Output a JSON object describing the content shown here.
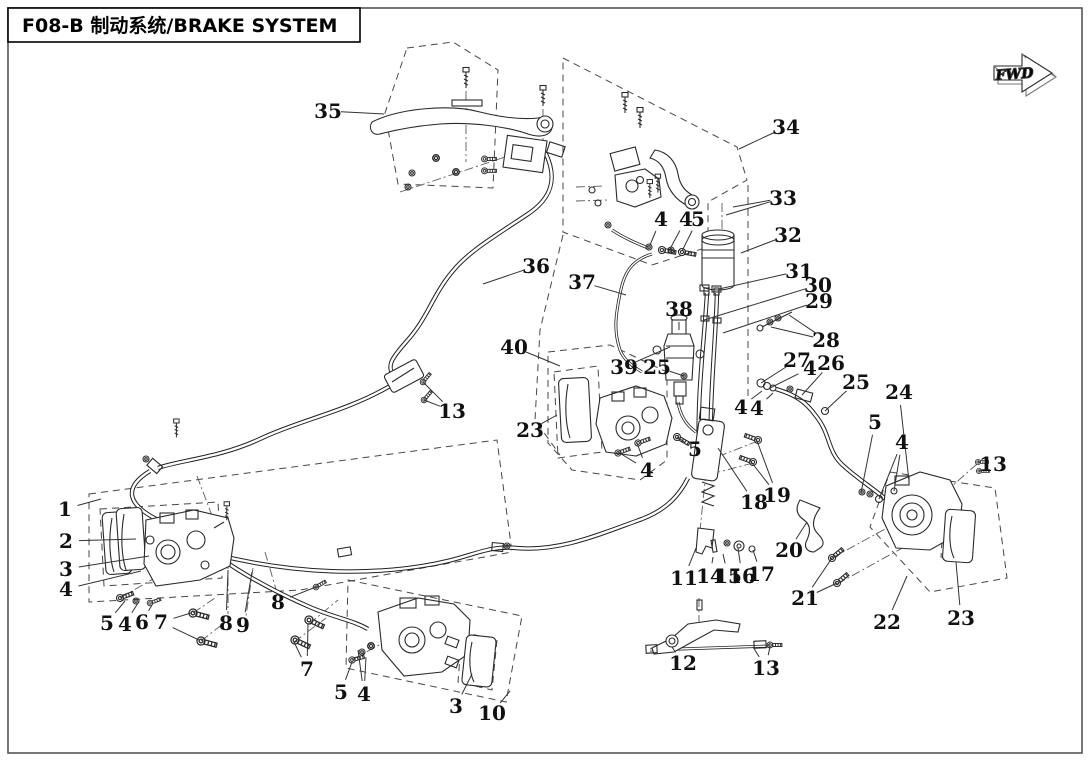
{
  "header": {
    "title": "F08-B 制动系统/BRAKE SYSTEM",
    "fwd": "FWD"
  },
  "parts": [
    {
      "label": "35",
      "x": 328,
      "y": 111,
      "leaders": [
        [
          384,
          114
        ]
      ]
    },
    {
      "label": "36",
      "x": 536,
      "y": 266,
      "leaders": [
        [
          483,
          284
        ]
      ]
    },
    {
      "label": "13",
      "x": 452,
      "y": 411,
      "leaders": [
        [
          423,
          382
        ],
        [
          424,
          400
        ]
      ]
    },
    {
      "label": "34",
      "x": 786,
      "y": 127,
      "leaders": [
        [
          739,
          149
        ]
      ]
    },
    {
      "label": "33",
      "x": 783,
      "y": 198,
      "leaders": [
        [
          726,
          215
        ],
        [
          733,
          207
        ]
      ]
    },
    {
      "label": "32",
      "x": 788,
      "y": 235,
      "leaders": [
        [
          741,
          253
        ]
      ]
    },
    {
      "label": "4",
      "x": 661,
      "y": 219,
      "leaders": [
        [
          650,
          245
        ]
      ]
    },
    {
      "label": "4",
      "x": 686,
      "y": 219,
      "leaders": [
        [
          670,
          249
        ]
      ]
    },
    {
      "label": "5",
      "x": 698,
      "y": 219,
      "leaders": [
        [
          682,
          251
        ]
      ]
    },
    {
      "label": "37",
      "x": 582,
      "y": 282,
      "leaders": [
        [
          626,
          295
        ]
      ]
    },
    {
      "label": "38",
      "x": 679,
      "y": 309,
      "leaders": [
        [
          679,
          330
        ]
      ]
    },
    {
      "label": "31",
      "x": 799,
      "y": 271,
      "leaders": [
        [
          719,
          289
        ]
      ]
    },
    {
      "label": "30",
      "x": 818,
      "y": 285,
      "leaders": [
        [
          704,
          320
        ]
      ]
    },
    {
      "label": "29",
      "x": 819,
      "y": 301,
      "leaders": [
        [
          723,
          333
        ]
      ]
    },
    {
      "label": "28",
      "x": 826,
      "y": 340,
      "leaders": [
        [
          789,
          315
        ],
        [
          771,
          327
        ]
      ]
    },
    {
      "label": "27",
      "x": 797,
      "y": 360,
      "leaders": [
        [
          761,
          383
        ]
      ]
    },
    {
      "label": "4",
      "x": 810,
      "y": 368,
      "leaders": [
        [
          770,
          388
        ]
      ]
    },
    {
      "label": "26",
      "x": 831,
      "y": 363,
      "leaders": [
        [
          802,
          395
        ]
      ]
    },
    {
      "label": "25",
      "x": 856,
      "y": 382,
      "leaders": [
        [
          825,
          411
        ]
      ]
    },
    {
      "label": "24",
      "x": 899,
      "y": 392,
      "leaders": [
        [
          909,
          481
        ]
      ]
    },
    {
      "label": "5",
      "x": 875,
      "y": 422,
      "leaders": [
        [
          861,
          493
        ]
      ]
    },
    {
      "label": "4",
      "x": 902,
      "y": 442,
      "leaders": [
        [
          879,
          499
        ],
        [
          894,
          491
        ]
      ]
    },
    {
      "label": "13",
      "x": 993,
      "y": 464,
      "leaders": [
        [
          978,
          462
        ],
        [
          979,
          471
        ]
      ]
    },
    {
      "label": "40",
      "x": 514,
      "y": 347,
      "leaders": [
        [
          560,
          366
        ]
      ]
    },
    {
      "label": "23",
      "x": 530,
      "y": 430,
      "leaders": [
        [
          557,
          415
        ]
      ]
    },
    {
      "label": "39",
      "x": 624,
      "y": 367,
      "leaders": [
        [
          670,
          347
        ]
      ]
    },
    {
      "label": "25",
      "x": 657,
      "y": 367,
      "leaders": [
        [
          684,
          376
        ]
      ]
    },
    {
      "label": "4",
      "x": 647,
      "y": 470,
      "leaders": [
        [
          618,
          452
        ],
        [
          637,
          443
        ]
      ]
    },
    {
      "label": "5",
      "x": 695,
      "y": 449,
      "leaders": [
        [
          677,
          437
        ]
      ]
    },
    {
      "label": "18",
      "x": 754,
      "y": 502,
      "leaders": [
        [
          718,
          448
        ]
      ]
    },
    {
      "label": "19",
      "x": 777,
      "y": 495,
      "leaders": [
        [
          757,
          441
        ],
        [
          752,
          463
        ]
      ]
    },
    {
      "label": "11",
      "x": 684,
      "y": 578,
      "leaders": [
        [
          696,
          548
        ]
      ]
    },
    {
      "label": "14",
      "x": 710,
      "y": 576,
      "leaders": [
        [
          713,
          557
        ]
      ]
    },
    {
      "label": "15",
      "x": 728,
      "y": 576,
      "leaders": [
        [
          723,
          554
        ]
      ]
    },
    {
      "label": "16",
      "x": 742,
      "y": 576,
      "leaders": [
        [
          738,
          548
        ]
      ]
    },
    {
      "label": "17",
      "x": 761,
      "y": 574,
      "leaders": [
        [
          753,
          550
        ]
      ]
    },
    {
      "label": "20",
      "x": 789,
      "y": 550,
      "leaders": [
        [
          807,
          522
        ]
      ]
    },
    {
      "label": "21",
      "x": 805,
      "y": 598,
      "leaders": [
        [
          832,
          558
        ],
        [
          837,
          583
        ]
      ]
    },
    {
      "label": "22",
      "x": 887,
      "y": 622,
      "leaders": [
        [
          907,
          576
        ]
      ]
    },
    {
      "label": "23",
      "x": 961,
      "y": 618,
      "leaders": [
        [
          956,
          562
        ]
      ]
    },
    {
      "label": "12",
      "x": 683,
      "y": 663,
      "leaders": [
        [
          672,
          647
        ]
      ]
    },
    {
      "label": "13",
      "x": 766,
      "y": 668,
      "leaders": [
        [
          753,
          647
        ],
        [
          770,
          646
        ]
      ]
    },
    {
      "label": "1",
      "x": 65,
      "y": 509,
      "leaders": [
        [
          101,
          499
        ]
      ]
    },
    {
      "label": "2",
      "x": 66,
      "y": 541,
      "leaders": [
        [
          136,
          539
        ]
      ]
    },
    {
      "label": "3",
      "x": 66,
      "y": 569,
      "leaders": [
        [
          149,
          556
        ]
      ]
    },
    {
      "label": "4",
      "x": 66,
      "y": 589,
      "leaders": [
        [
          141,
          571
        ]
      ]
    },
    {
      "label": "5",
      "x": 107,
      "y": 623,
      "leaders": [
        [
          125,
          601
        ]
      ]
    },
    {
      "label": "4",
      "x": 125,
      "y": 624,
      "leaders": [
        [
          138,
          603
        ]
      ]
    },
    {
      "label": "6",
      "x": 142,
      "y": 622,
      "leaders": [
        [
          152,
          605
        ]
      ]
    },
    {
      "label": "7",
      "x": 161,
      "y": 622,
      "leaders": [
        [
          191,
          613
        ],
        [
          199,
          640
        ]
      ]
    },
    {
      "label": "8",
      "x": 226,
      "y": 623,
      "leaders": [
        [
          228,
          570
        ]
      ]
    },
    {
      "label": "9",
      "x": 243,
      "y": 625,
      "leaders": [
        [
          252,
          572
        ]
      ]
    },
    {
      "label": "8",
      "x": 278,
      "y": 602,
      "leaders": [
        [
          316,
          587
        ]
      ]
    },
    {
      "label": "7",
      "x": 307,
      "y": 669,
      "leaders": [
        [
          308,
          624
        ],
        [
          294,
          642
        ]
      ]
    },
    {
      "label": "5",
      "x": 341,
      "y": 692,
      "leaders": [
        [
          352,
          662
        ]
      ]
    },
    {
      "label": "4",
      "x": 364,
      "y": 694,
      "leaders": [
        [
          366,
          657
        ],
        [
          358,
          650
        ]
      ]
    },
    {
      "label": "3",
      "x": 456,
      "y": 706,
      "leaders": [
        [
          472,
          674
        ]
      ]
    },
    {
      "label": "10",
      "x": 492,
      "y": 713,
      "leaders": [
        [
          510,
          691
        ]
      ]
    },
    {
      "label": "4",
      "x": 741,
      "y": 407,
      "leaders": [
        [
          762,
          391
        ]
      ]
    },
    {
      "label": "4",
      "x": 757,
      "y": 408,
      "leaders": [
        [
          773,
          393
        ]
      ]
    }
  ]
}
